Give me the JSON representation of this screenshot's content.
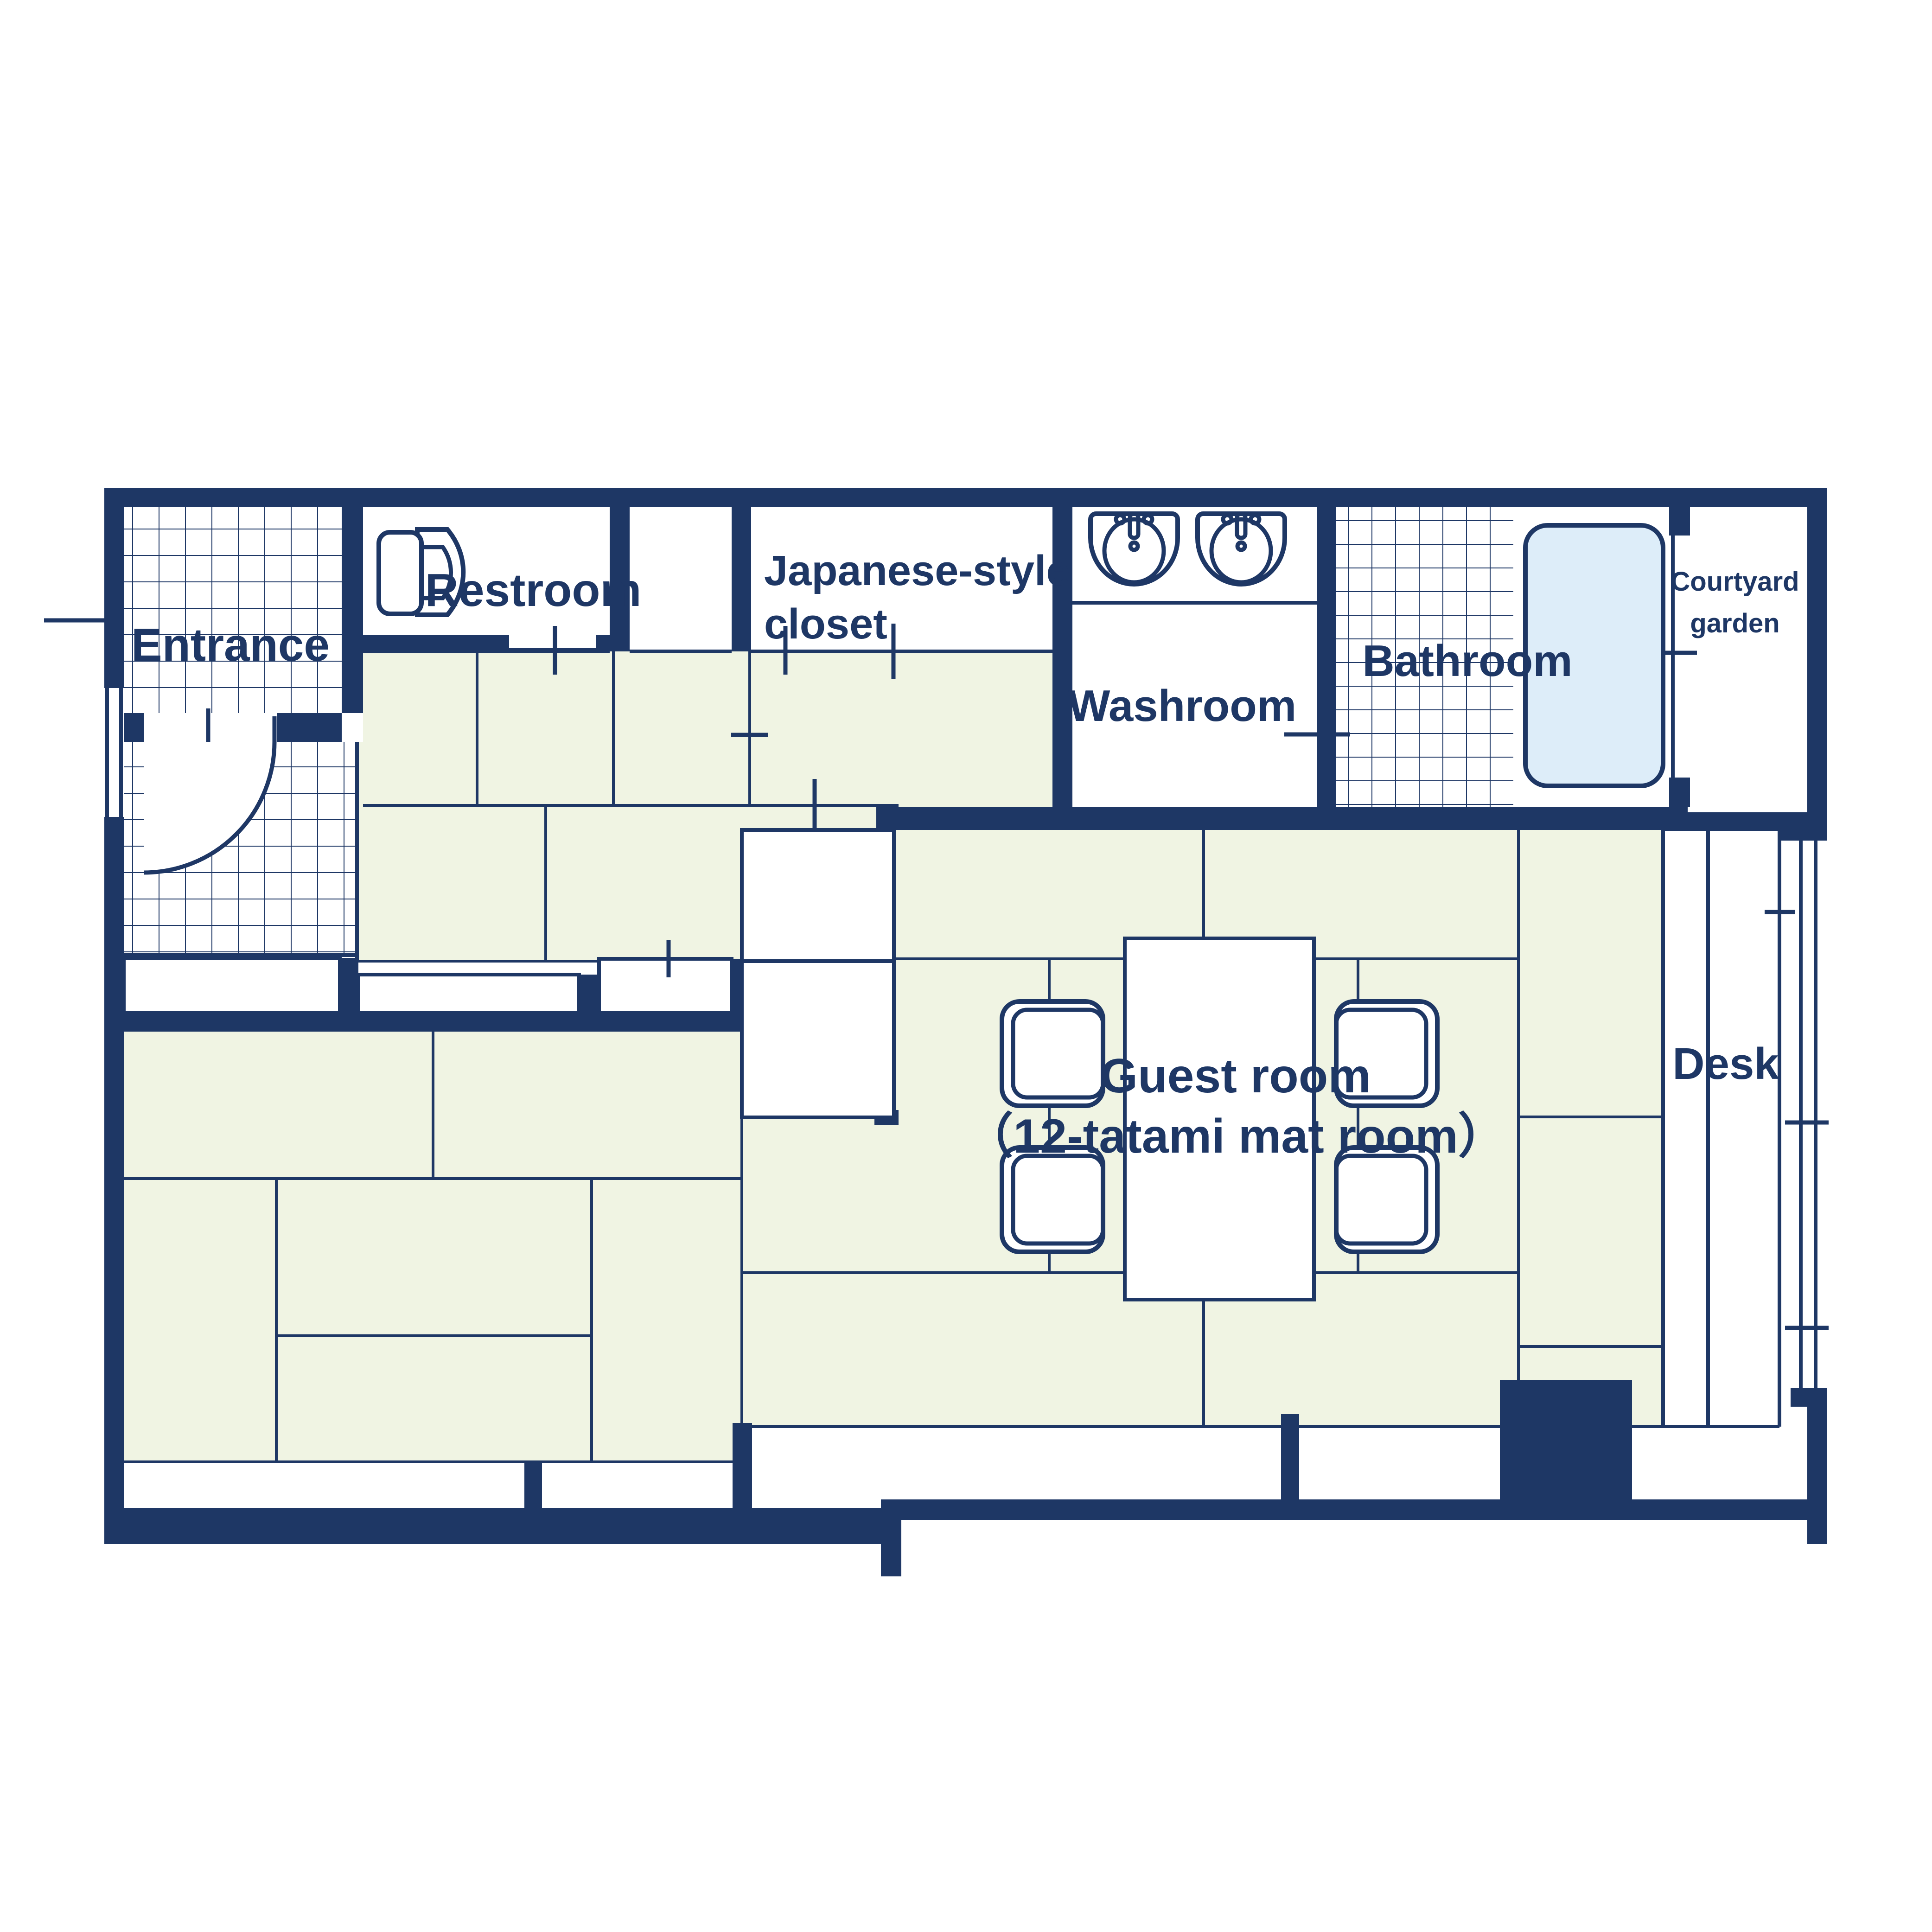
{
  "floorplan": {
    "title": "Guest room floor plan",
    "colors": {
      "wall": "#1e3765",
      "tatami": "#f0f4e3",
      "bath": "#ddedf9",
      "text": "#1e3765",
      "background": "#ffffff"
    },
    "rooms": {
      "entrance": {
        "label": "Entrance"
      },
      "restroom": {
        "label": "Restroom"
      },
      "japanese_closet": {
        "label_line1": "Japanese-style",
        "label_line2": "closet"
      },
      "washroom": {
        "label": "Washroom"
      },
      "bathroom": {
        "label": "Bathroom"
      },
      "courtyard_garden": {
        "label_line1": "Courtyard",
        "label_line2": "garden"
      },
      "guest_room": {
        "label_line1": "Guest room",
        "label_line2": "（12-tatami mat room）"
      },
      "desk": {
        "label": "Desk"
      }
    },
    "fixtures": {
      "toilet": "toilet-icon",
      "sinks": "double-sink-icons",
      "bathtub": "bathtub",
      "table": "low-table",
      "chairs": "four-floor-chairs",
      "entry_door": "swing-door-arc"
    }
  }
}
